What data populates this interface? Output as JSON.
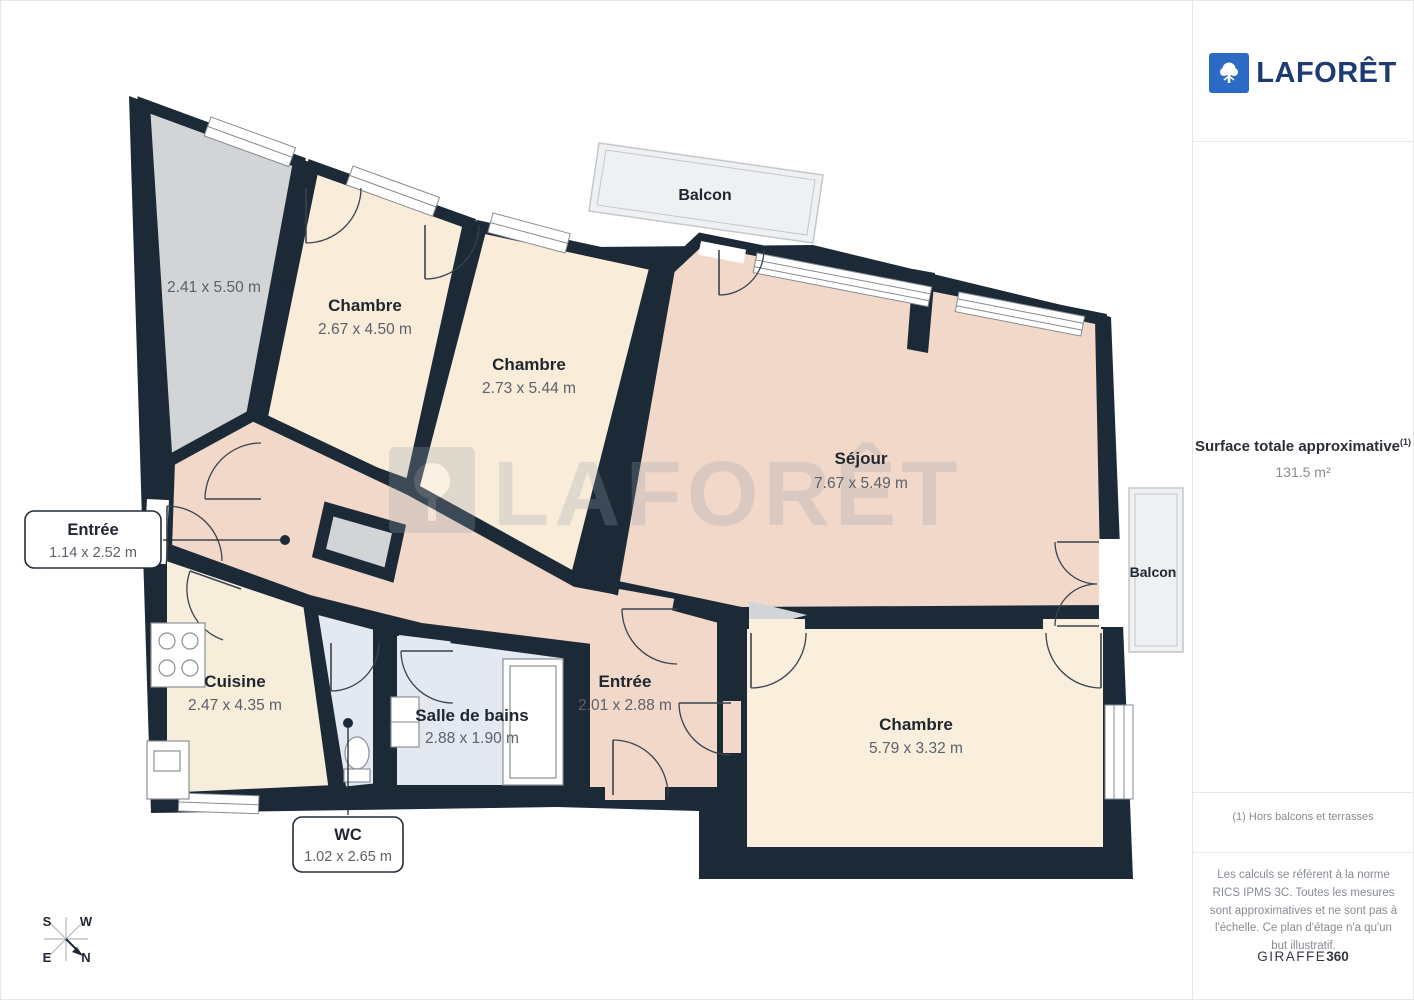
{
  "sidebar": {
    "brand": "LAFORÊT",
    "surface_title": "Surface totale approximative",
    "surface_superscript": "(1)",
    "surface_value": "131.5 m²",
    "footnote": "(1) Hors balcons et terrasses",
    "disclaimer": "Les calculs se réfèrent à la norme RICS IPMS 3C. Toutes les mesures sont approximatives et ne sont pas à l'échelle. Ce plan d'étage n'a qu'un but illustratif.",
    "vendor_name": "GIRAFFE",
    "vendor_suffix": "360"
  },
  "watermark": {
    "text": "LAFORÊT"
  },
  "rooms": [
    {
      "name": "",
      "dims": "2.41 x 5.50 m"
    },
    {
      "name": "Chambre",
      "dims": "2.67 x 4.50 m"
    },
    {
      "name": "Chambre",
      "dims": "2.73 x 5.44 m"
    },
    {
      "name": "Séjour",
      "dims": "7.67 x 5.49 m"
    },
    {
      "name": "Chambre",
      "dims": "5.79 x 3.32 m"
    },
    {
      "name": "Entrée",
      "dims": "2.01 x 2.88 m"
    },
    {
      "name": "Salle de bains",
      "dims": "2.88 x 1.90 m"
    },
    {
      "name": "Cuisine",
      "dims": "2.47 x 4.35 m"
    }
  ],
  "balconies": {
    "top": "Balcon",
    "right": "Balcon"
  },
  "callouts": [
    {
      "name": "Entrée",
      "dims": "1.14 x 2.52 m"
    },
    {
      "name": "WC",
      "dims": "1.02 x 2.65 m"
    }
  ],
  "compass": {
    "s": "S",
    "w": "W",
    "e": "E",
    "n": "N"
  },
  "palette": {
    "wall": "#1c2a38",
    "bedroom_fill": "#f9edda",
    "living_fill": "#f1d8c8",
    "bath_fill": "#e4e9f1",
    "kitchen_fill": "#f6eeda",
    "unlabeled_fill": "#d2d4d6",
    "balcony_fill": "#eef0f2",
    "brand_blue": "#2b6bc6",
    "brand_navy": "#1d3a73"
  }
}
